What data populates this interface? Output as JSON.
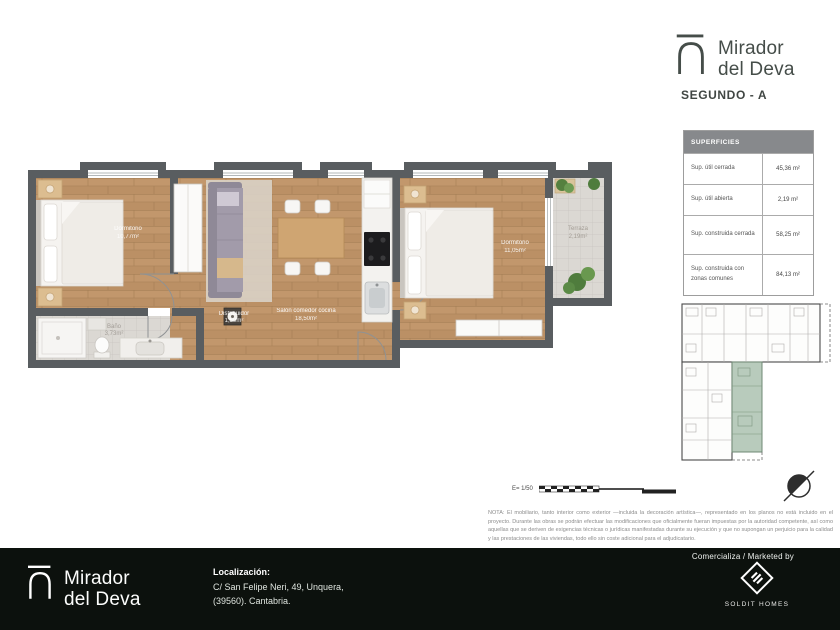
{
  "header": {
    "brand_line1": "Mirador",
    "brand_line2": "del Deva",
    "plan_title": "SEGUNDO - A"
  },
  "surfaces_table": {
    "title": "SUPERFICIES",
    "rows": [
      {
        "label": "Sup. útil cerrada",
        "value": "45,36 m²"
      },
      {
        "label": "Sup. útil abierta",
        "value": "2,19 m²"
      },
      {
        "label": "Sup. construida cerrada",
        "value": "58,25 m²"
      },
      {
        "label": "Sup. construida con zonas comunes",
        "value": "84,13 m²"
      }
    ]
  },
  "floor_plan": {
    "rooms": [
      {
        "name": "Dormitorio",
        "area": "10,77m²"
      },
      {
        "name": "Baño",
        "area": "3,73m²"
      },
      {
        "name": "Distribuidor",
        "area": "1,59m²"
      },
      {
        "name": "Salón comedor cocina",
        "area": "18,50m²"
      },
      {
        "name": "Dormitorio",
        "area": "11,05m²"
      },
      {
        "name": "Terraza",
        "area": "2,19m²"
      }
    ]
  },
  "scale": {
    "label": "E= 1/50"
  },
  "note": {
    "text": "NOTA: El mobiliario, tanto interior como exterior —incluida la decoración artística—, representado en los planos no está incluido en el proyecto. Durante las obras se podrán efectuar las modificaciones que oficialmente fueran impuestas por la autoridad competente, así como aquellas que se deriven de exigencias técnicas o jurídicas manifestadas durante su ejecución y que no supongan un perjuicio para la calidad y las prestaciones de las viviendas, todo ello sin coste adicional para el adjudicatario."
  },
  "footer": {
    "marketed_by": "Comercializa / Marketed by",
    "brand_line1": "Mirador",
    "brand_line2": "del Deva",
    "localizacion_label": "Localización:",
    "address_line1": "C/ San Felipe Neri, 49, Unquera,",
    "address_line2": "(39560). Cantabria.",
    "agency": "SOLDIT HOMES"
  },
  "colors": {
    "wall": "#595d60",
    "wood_floor": "#bf9468",
    "tile_floor": "#dbd8d3",
    "unit_highlight": "#b8cbbc",
    "footer_bg": "#0c110d",
    "brand_text": "#454d49"
  }
}
